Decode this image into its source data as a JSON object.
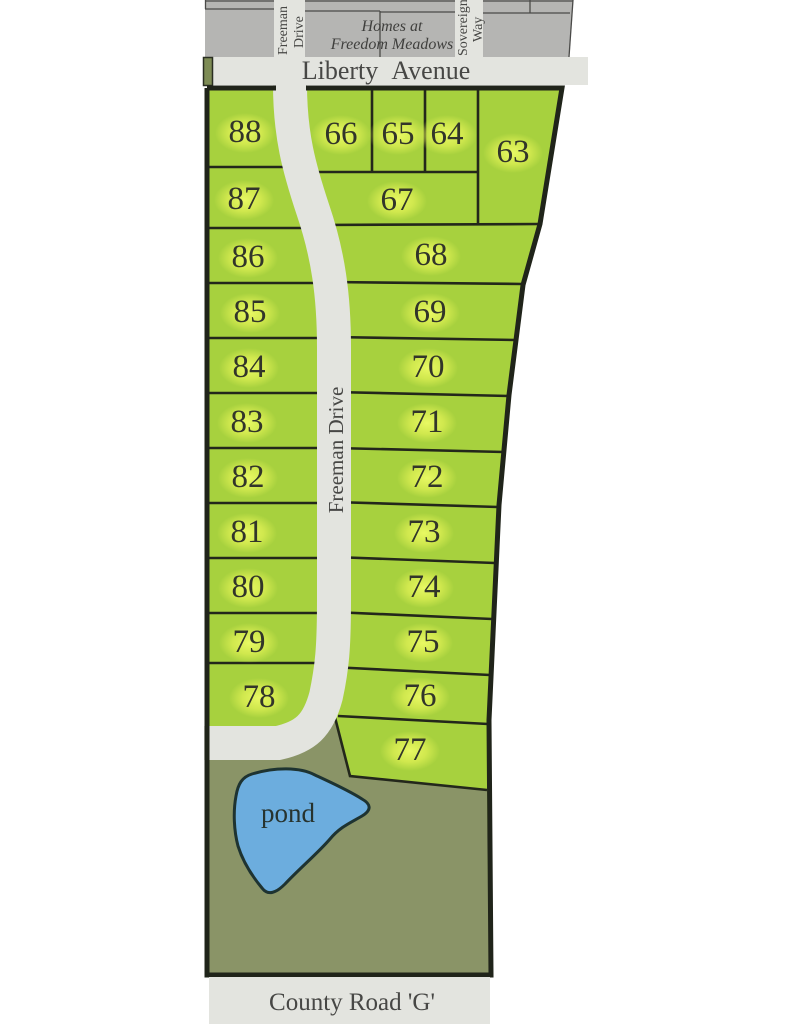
{
  "map": {
    "subdivision": {
      "name_line1": "Homes at",
      "name_line2": "Freedom Meadows"
    },
    "streets": {
      "liberty": "Liberty Avenue",
      "county": "County Road 'G'",
      "freeman_top_line1": "Freeman",
      "freeman_top_line2": "Drive",
      "freeman_mid": "Freeman Drive",
      "sovereign_line1": "Sovereign",
      "sovereign_line2": "Way"
    },
    "pond_label": "pond",
    "lots": [
      {
        "label": "63"
      },
      {
        "label": "64"
      },
      {
        "label": "65"
      },
      {
        "label": "66"
      },
      {
        "label": "67"
      },
      {
        "label": "68"
      },
      {
        "label": "69"
      },
      {
        "label": "70"
      },
      {
        "label": "71"
      },
      {
        "label": "72"
      },
      {
        "label": "73"
      },
      {
        "label": "74"
      },
      {
        "label": "75"
      },
      {
        "label": "76"
      },
      {
        "label": "77"
      },
      {
        "label": "78"
      },
      {
        "label": "79"
      },
      {
        "label": "80"
      },
      {
        "label": "81"
      },
      {
        "label": "82"
      },
      {
        "label": "83"
      },
      {
        "label": "84"
      },
      {
        "label": "85"
      },
      {
        "label": "86"
      },
      {
        "label": "87"
      },
      {
        "label": "88"
      }
    ],
    "colors": {
      "lot_green": "#a7d13e",
      "open_space_green": "#8a9467",
      "pond_blue": "#6cadde",
      "road_light": "#e3e4df",
      "parcel_gray": "#b5b5b3",
      "outline_dark": "#20241a",
      "glow_yellow": "#e6f75a"
    }
  }
}
